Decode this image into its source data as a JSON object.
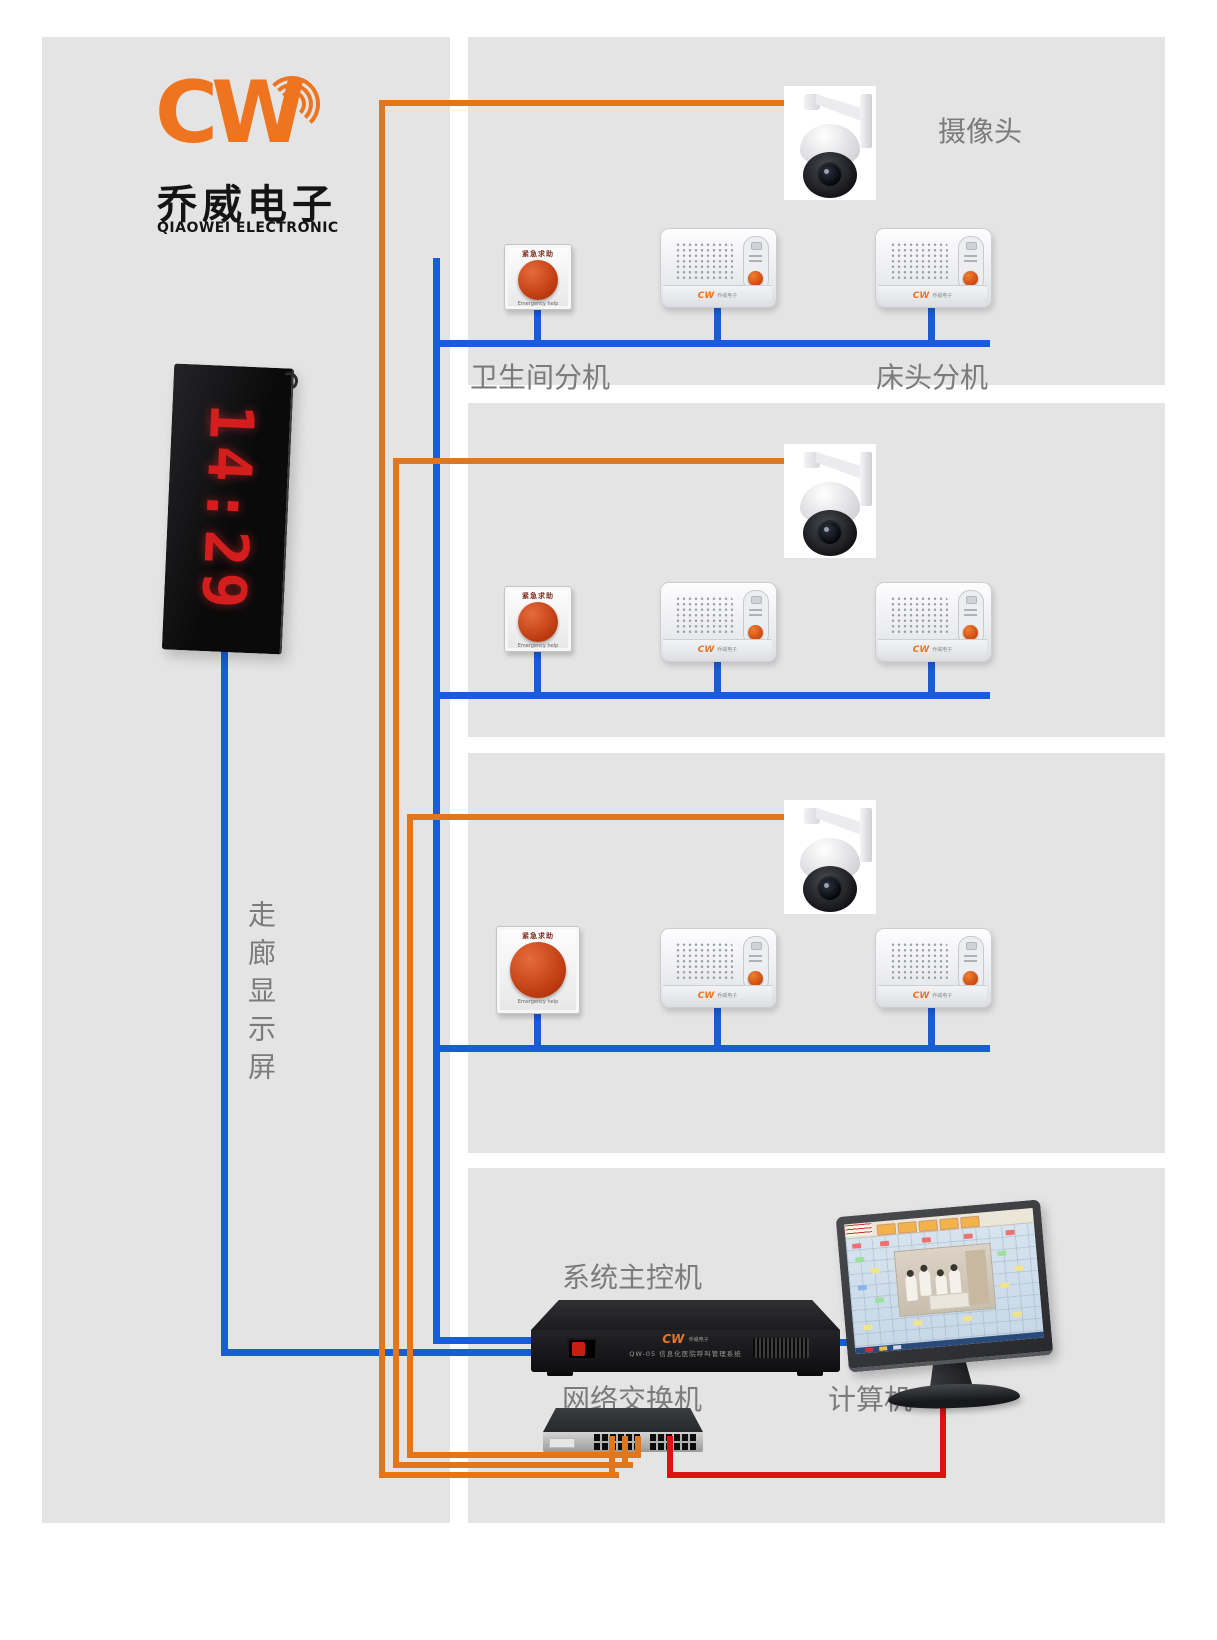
{
  "brand": {
    "logo": "CW",
    "company_cn": "乔威电子",
    "company_en": "QIAOWEI ELECTRONIC"
  },
  "corridor_display": {
    "time": "14:29",
    "label": "走廊显示屏"
  },
  "floors": [
    {
      "camera_label": "摄像头",
      "toilet_station_label": "卫生间分机",
      "bed_station_label": "床头分机"
    },
    {},
    {}
  ],
  "device_text": {
    "emergency_title": "紧急求助",
    "emergency_subtitle": "Emergency help",
    "intercom_brand": "CW",
    "intercom_brand_cn": "乔威电子"
  },
  "control_room": {
    "controller_label": "系统主控机",
    "controller_brand": "CW",
    "controller_brand_cn": "乔威电子",
    "controller_model_text": "QW-05 信息化医院呼叫管理系统",
    "switch_label": "网络交换机",
    "computer_label": "计算机"
  },
  "colors": {
    "panel_gray": "#e4e4e4",
    "wire_blue": "#185cd6",
    "wire_orange": "#e2761b",
    "wire_red": "#de1212",
    "brand_orange": "#ee7420",
    "led_red": "#d41d1d",
    "label_gray": "#7b7b7b"
  }
}
